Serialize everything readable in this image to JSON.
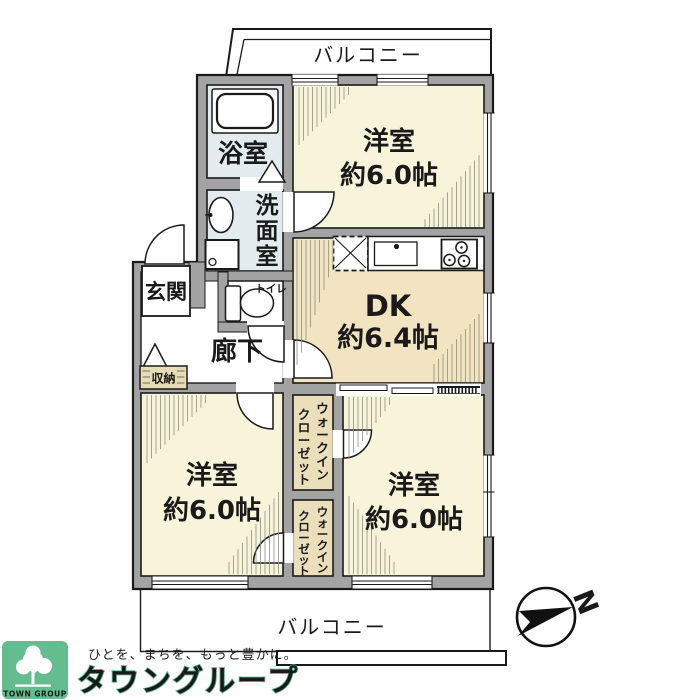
{
  "plan": {
    "balcony_top": "バルコニー",
    "balcony_bottom": "バルコニー",
    "bath": "浴室",
    "washroom": "洗面室",
    "toilet": "トイレ",
    "entrance": "玄関",
    "hallway": "廊下",
    "storage": "収納",
    "dk_name": "DK",
    "dk_size": "約6.4帖",
    "bedroom_top": {
      "name": "洋室",
      "size": "約6.0帖"
    },
    "bedroom_left": {
      "name": "洋室",
      "size": "約6.0帖"
    },
    "bedroom_right": {
      "name": "洋室",
      "size": "約6.0帖"
    },
    "wic_line1": "ウォークイン",
    "wic_line2": "クローゼット",
    "compass_north": "N"
  },
  "branding": {
    "logo_text": "TOWN GROUP",
    "tagline": "ひとを、まちを、もっと豊かに。",
    "company": "タウングループ"
  },
  "colors": {
    "wall": "#a3a3a3",
    "room_cream": "#f7f4da",
    "room_tan": "#f2e3c1",
    "closet_tan": "#eadfba",
    "wet_blue": "#e2ebee",
    "white": "#ffffff",
    "brand_green": "#64bd8e",
    "tagline_gray": "#8b958f"
  }
}
